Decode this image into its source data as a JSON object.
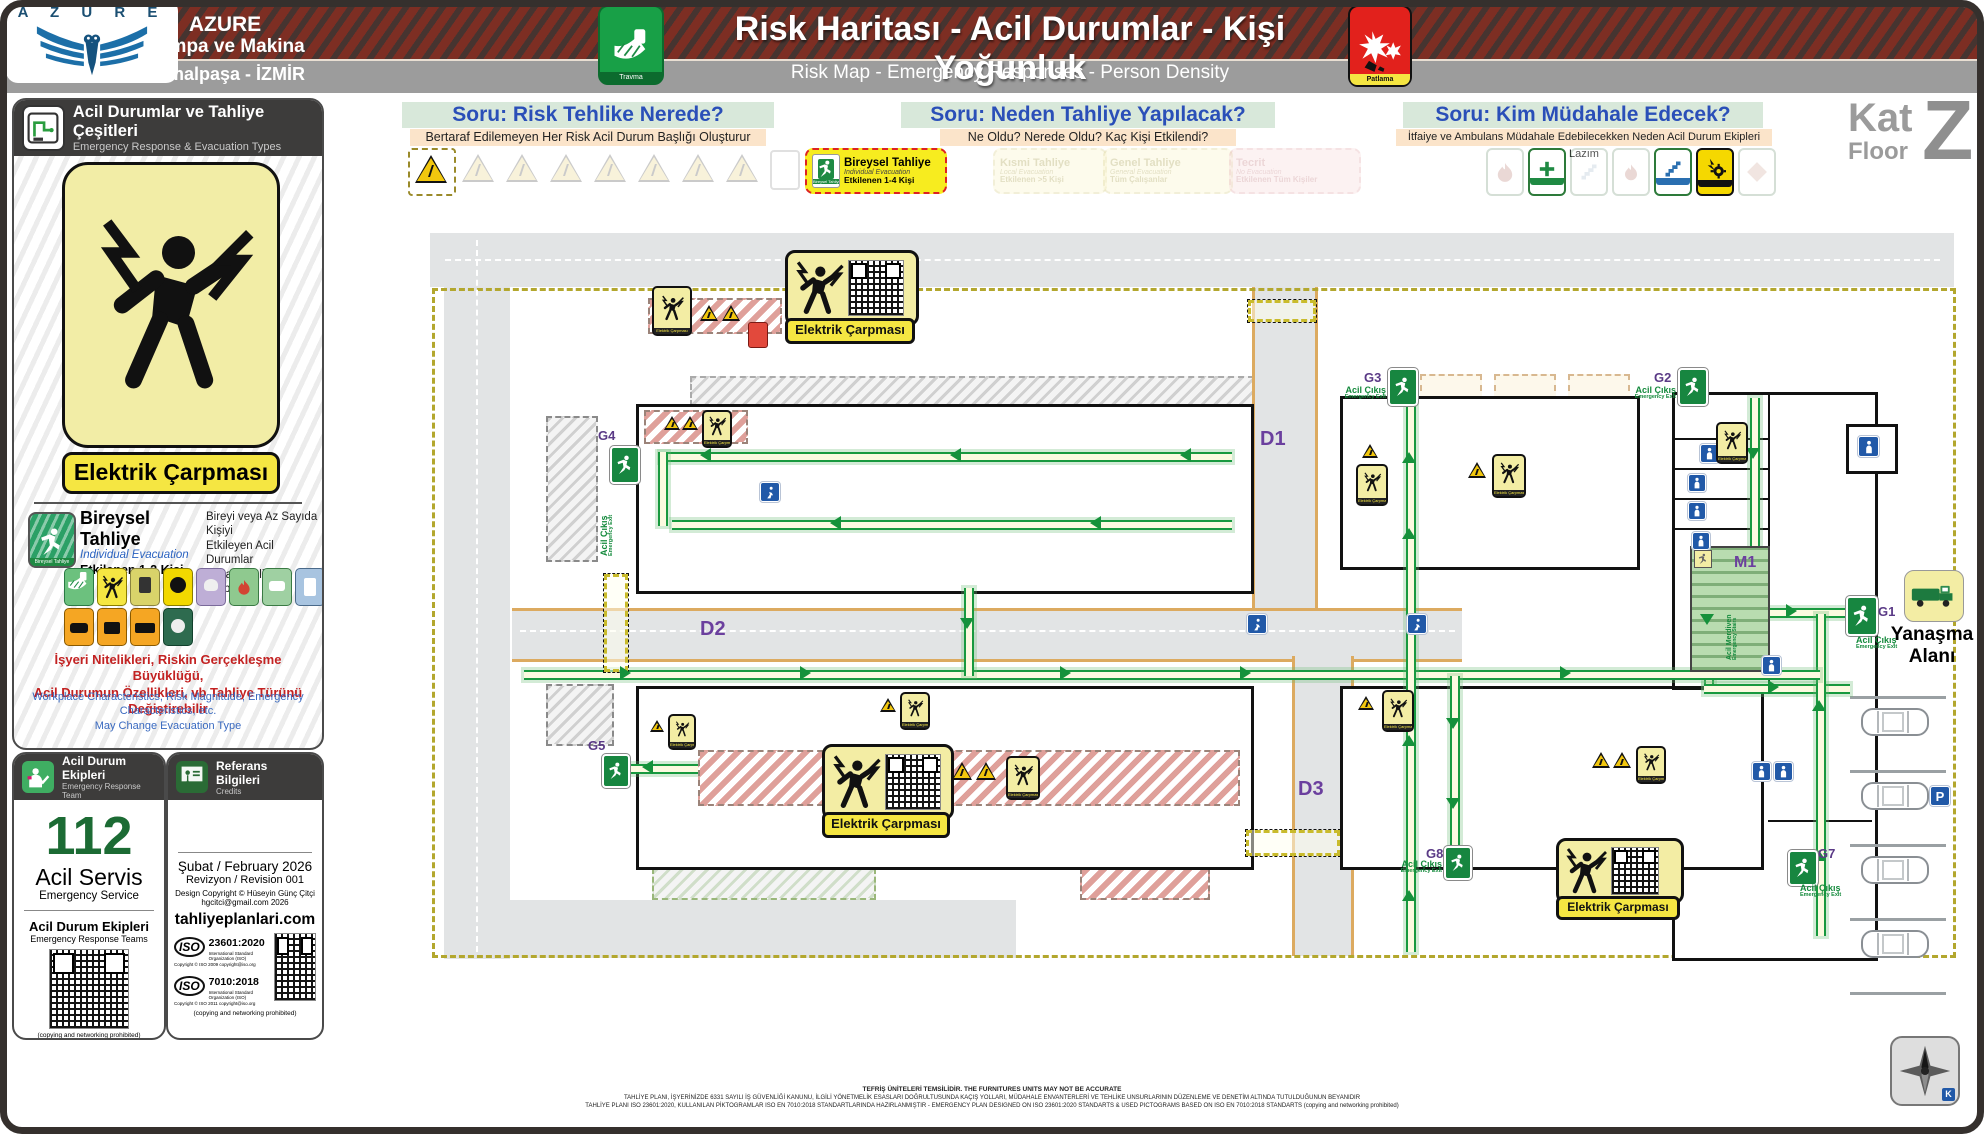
{
  "header": {
    "logo_letters": "A Z U R E",
    "company": "AZURE",
    "company_line2": "Pompa ve Makina",
    "location": "Kemalpaşa - İZMİR",
    "title": "Risk Haritası - Acil Durumlar - Kişi Yoğunluk",
    "subtitle": "Risk Map - Emergency Responses - Person Density",
    "travma_label": "Travma",
    "patlama_label": "Patlama"
  },
  "floor_badge": {
    "kat": "Kat",
    "floor": "Floor",
    "letter": "Z"
  },
  "questions": [
    {
      "title": "Soru: Risk Tehlike Nerede?",
      "subtitle": "Bertaraf Edilemeyen Her Risk Acil Durum Başlığı Oluşturur"
    },
    {
      "title": "Soru: Neden Tahliye Yapılacak?",
      "subtitle": "Ne Oldu? Nerede Oldu? Kaç Kişi Etkilendi?"
    },
    {
      "title": "Soru: Kim Müdahale Edecek?",
      "subtitle": "İtfaiye ve Ambulans Müdahale Edebilecekken Neden Acil Durum Ekipleri Lazım"
    }
  ],
  "evac_options": [
    {
      "title": "Bireysel Tahliye",
      "sub": "Individual Evacuation",
      "count": "Etkilenen 1-4 Kişi"
    },
    {
      "title": "Kısmi Tahliye",
      "sub": "Local Evacuation",
      "count": "Etkilenen >5 Kişi"
    },
    {
      "title": "Genel Tahliye",
      "sub": "General Evacuation",
      "count": "Tüm Çalışanlar"
    },
    {
      "title": "Tecrit",
      "sub": "No Evacuation",
      "count": "Etkilenen Tüm Kişiler"
    }
  ],
  "sidebar": {
    "panel1": {
      "title": "Acil Durumlar ve Tahliye Çeşitleri",
      "subtitle": "Emergency Response & Evacuation Types",
      "sign_title": "Elektrik Çarpması",
      "evac": {
        "title": "Bireysel Tahliye",
        "sub": "Individual Evacuation",
        "count": "Etkilenen 1-2 Kişi",
        "desc1": "Bireyi veya Az Sayıda Kişiyi",
        "desc2": "Etkileyen Acil Durumlar",
        "desc3": "[Yatay Tahliye Olabilir]"
      },
      "note_tr1": "İşyeri Nitelikleri, Riskin Gerçekleşme Büyüklüğü,",
      "note_tr2": "Acil Durumun Özellikleri, vb Tahliye Türünü Değiştirebilir",
      "note_en1": "Workplace Characteristics, Risk Magnitude, Emergency Characteristics, etc.",
      "note_en2": "May Change Evacuation Type"
    },
    "panel2": {
      "title": "Acil Durum Ekipleri",
      "subtitle": "Emergency Response Team",
      "number": "112",
      "service": "Acil Servis",
      "service_en": "Emergency Service",
      "teams": "Acil Durum Ekipleri",
      "teams_en": "Emergency Response Teams",
      "copy_note": "(copying and networking prohibited)"
    },
    "panel3": {
      "title": "Referans Bilgileri",
      "subtitle": "Credits",
      "date_line": "Şubat / February 2026",
      "rev_line": "Revizyon / Revision 001",
      "design1": "Design Copyright © Hüseyin Günç Çitçi",
      "design2": "hgcitci@gmail.com 2026",
      "site": "tahliyeplanlari.com",
      "iso_label": "ISO",
      "iso1_code": "23601:2020",
      "iso1_org": "International Standard Organization (ISO)",
      "iso1_copy": "Copyright © ISO 2009 copyright@iso.org",
      "iso2_code": "7010:2018",
      "iso2_org": "International Standard Organization (ISO)",
      "iso2_copy": "Copyright © ISO 2011 copyright@iso.org",
      "copy_note": "(copying and networking prohibited)"
    }
  },
  "plan": {
    "sign_label": "Elektrik Çarpması",
    "exit_tr": "Acil Çıkış",
    "exit_en": "Emergency Exit",
    "exits": {
      "g1": "G1",
      "g2": "G2",
      "g3": "G3",
      "g4": "G4",
      "g5": "G5",
      "g7": "G7",
      "g8": "G8"
    },
    "doors": {
      "d1": "D1",
      "d2": "D2",
      "d3": "D3"
    },
    "stairs_id": "M1",
    "stairs_tr": "Acil Merdiven",
    "stairs_en": "Emergency Stairs",
    "yanasma1": "Yanaşma",
    "yanasma2": "Alanı",
    "parking": "P",
    "compass_k": "K"
  },
  "footer": {
    "line1": "TEFRİŞ ÜNİTELERİ TEMSİLİDİR. THE FURNITURES UNITS MAY NOT BE ACCURATE",
    "line2": "TAHLİYE PLANI, İŞYERİNİZDE 6331 SAYILI İŞ GÜVENLİĞİ KANUNU, İLGİLİ YÖNETMELİK ESASLARI DOĞRULTUSUNDA KAÇIŞ YOLLARI, MÜDAHALE ENVANTERLERİ VE TEHLİKE UNSURLARININ DÜZENLEME VE DENETİM ALTINDA TUTULDUĞUNUN BEYANIDIR",
    "line3": "TAHLİYE PLANI ISO 23601:2020, KULLANILAN PİKTOGRAMLAR ISO EN 7010:2018 STANDARTLARINDA HAZIRLANMIŞTIR - EMERGENCY PLAN DESIGNED ON ISO 23601:2020 STANDARTS & USED PICTOGRAMS BASED ON ISO EN 7010:2018 STANDARTS (copying and networking prohibited)"
  }
}
